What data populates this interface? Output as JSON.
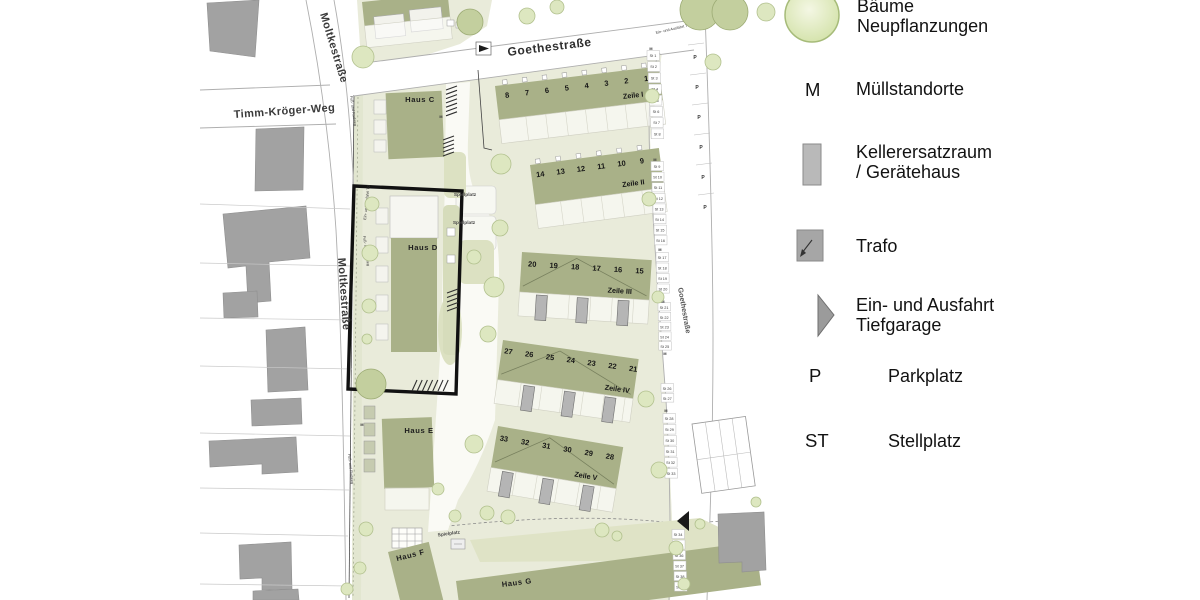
{
  "legend": {
    "items": [
      {
        "swatch": "tree",
        "label_lines": [
          "Bäume",
          "Neupflanzungen"
        ]
      },
      {
        "swatch": "letter",
        "key": "M",
        "label_lines": [
          "Müllstandorte"
        ]
      },
      {
        "swatch": "keller",
        "label_lines": [
          "Kellerersatzraum",
          "/ Gerätehaus"
        ]
      },
      {
        "swatch": "trafo",
        "label_lines": [
          "Trafo"
        ]
      },
      {
        "swatch": "triangle",
        "label_lines": [
          "Ein- und Ausfahrt",
          "Tiefgarage"
        ]
      },
      {
        "swatch": "letter",
        "key": "P",
        "label_lines": [
          "Parkplatz"
        ]
      },
      {
        "swatch": "letter",
        "key": "ST",
        "label_lines": [
          "Stellplatz"
        ]
      }
    ]
  },
  "map": {
    "streets": {
      "moltkestrasse": "Moltkestraße",
      "goethestrasse": "Goethestraße",
      "timm_kroeger_weg": "Timm-Kröger-Weg"
    },
    "houses": {
      "haus_c": "Haus C",
      "haus_d": "Haus D",
      "haus_e": "Haus E",
      "haus_f": "Haus F",
      "haus_g": "Haus G"
    },
    "zeilen": [
      {
        "label": "Zeile I",
        "units": [
          "8",
          "7",
          "6",
          "5",
          "4",
          "3",
          "2",
          "1"
        ]
      },
      {
        "label": "Zeile II",
        "units": [
          "14",
          "13",
          "12",
          "11",
          "10",
          "9"
        ]
      },
      {
        "label": "Zeile III",
        "units": [
          "20",
          "19",
          "18",
          "17",
          "16",
          "15"
        ]
      },
      {
        "label": "Zeile IV",
        "units": [
          "27",
          "26",
          "25",
          "24",
          "23",
          "22",
          "21"
        ]
      },
      {
        "label": "Zeile V",
        "units": [
          "33",
          "32",
          "31",
          "30",
          "29",
          "28"
        ]
      }
    ],
    "annotations": {
      "spielplatz": "Spielplatz",
      "fussweg": "Fuß- und Radweg",
      "tiefgarage": "Ein- und Ausfahrt TG",
      "muell": "M",
      "parken": "P"
    },
    "stellplaetze": [
      [
        "St 1",
        "St 2",
        "St 3",
        "St 4",
        "St 5",
        "St 6",
        "St 7",
        "St 8"
      ],
      [
        "St 9",
        "St 10",
        "St 11",
        "St 12",
        "St 13",
        "St 14",
        "St 15",
        "St 16"
      ],
      [
        "St 17",
        "St 18",
        "St 19",
        "St 20"
      ],
      [
        "St 21",
        "St 22",
        "St 23",
        "St 24",
        "St 25"
      ],
      [
        "St 26",
        "St 27"
      ],
      [
        "St 28",
        "St 29",
        "St 30",
        "St 31",
        "St 32",
        "St 33"
      ],
      [
        "St 34",
        "St 35",
        "St 36",
        "St 37",
        "St 38",
        "St 39"
      ]
    ]
  },
  "colors": {
    "site": "#e9ebda",
    "building_new": "#a9b188",
    "building_old": "#a2a2a2",
    "tree": "#dde7c0",
    "tree_dark": "#c3cf9e",
    "highlight": "#111111"
  }
}
